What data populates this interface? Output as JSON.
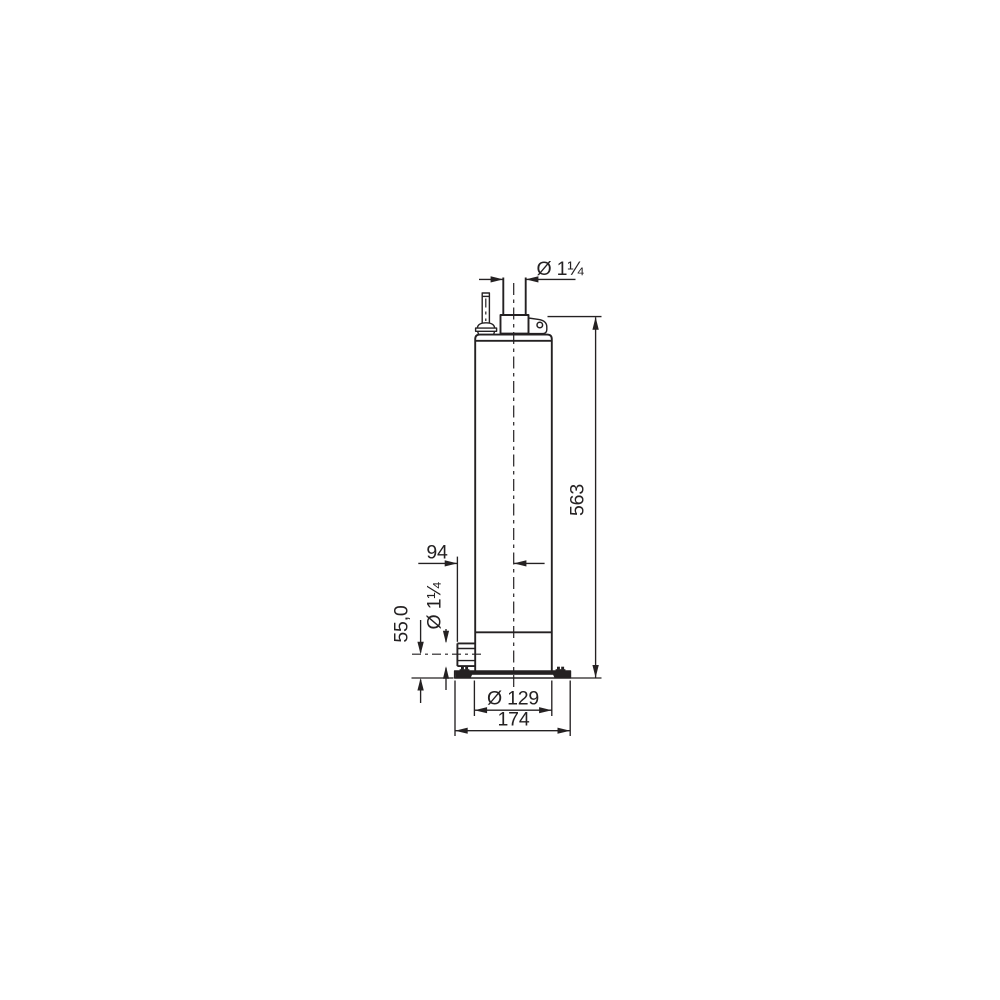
{
  "background_color": "#ffffff",
  "line_color": "#242122",
  "figure": {
    "labels": {
      "discharge_diameter": "Ø 1¼",
      "overall_height": "563",
      "centerline_to_inlet_face": "94",
      "inlet_diameter": "Ø 1¼",
      "inlet_centerline_height": "55,0",
      "pump_body_diameter": "Ø 129",
      "base_plate_width": "174"
    }
  }
}
